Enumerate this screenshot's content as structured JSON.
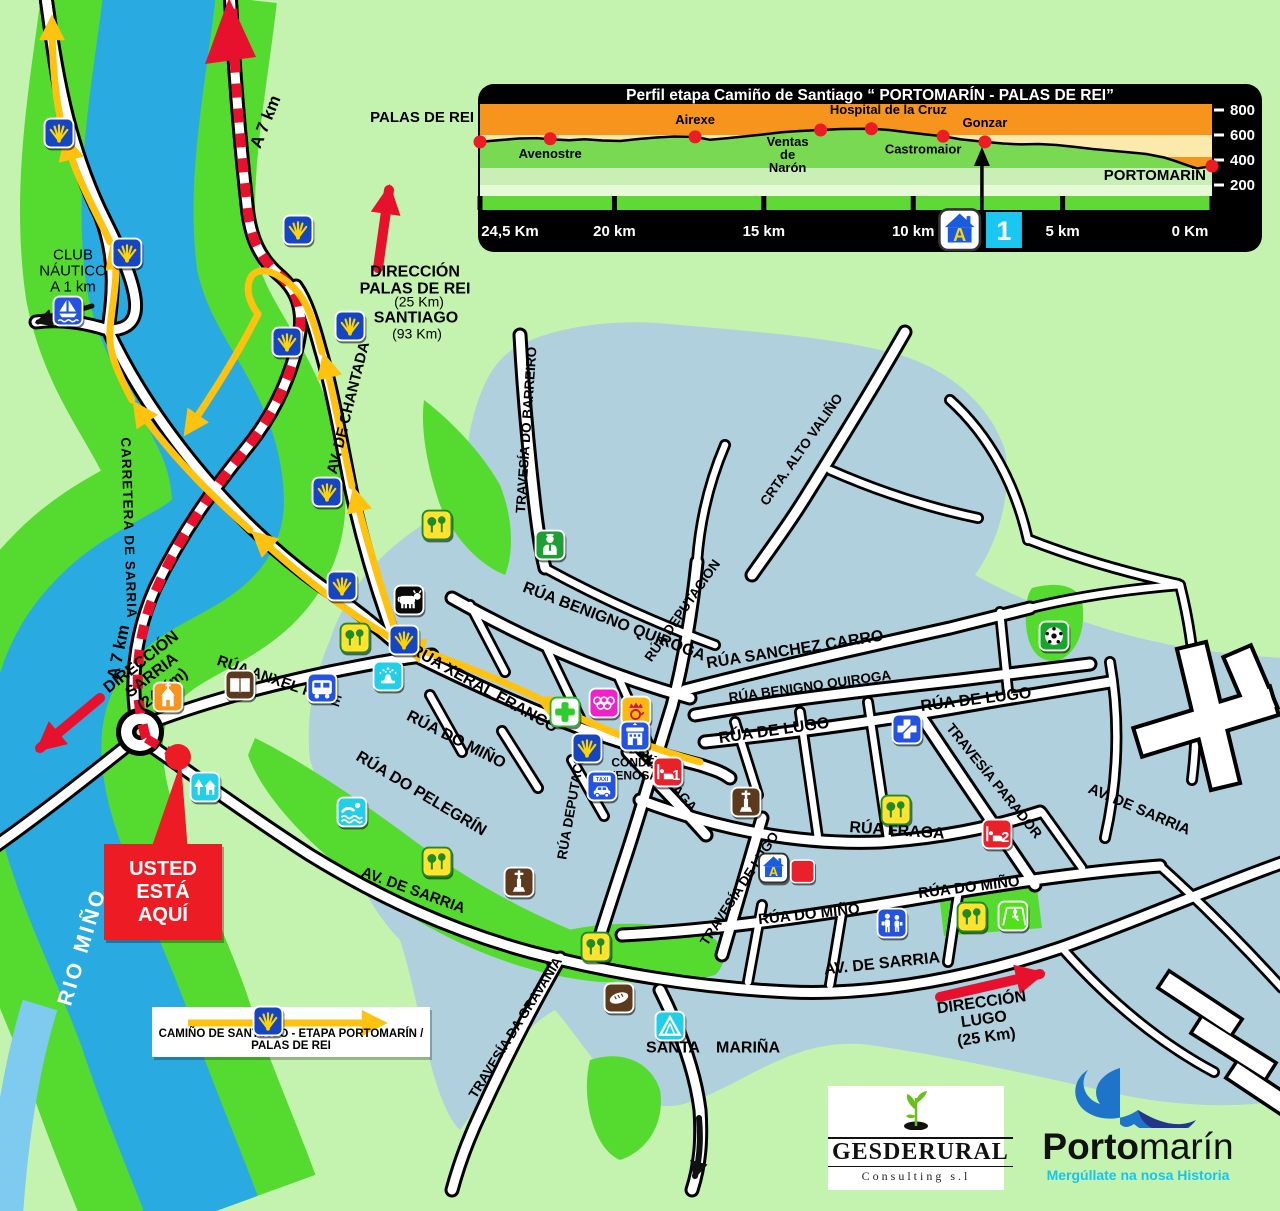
{
  "chart_data": {
    "type": "area",
    "title": "Perfil etapa Camiño de Santiago “ PORTOMARÍN - PALAS DE REI”",
    "xlabel": "distancia",
    "ylabel": "altitud (m)",
    "xlim": [
      24.5,
      0
    ],
    "ylim": [
      200,
      800
    ],
    "grid": false,
    "x_ticks": [
      "24,5 Km",
      "20 km",
      "15 km",
      "10 km",
      "5 km",
      "0 Km"
    ],
    "x_tick_values": [
      24.5,
      20,
      15,
      10,
      5,
      0
    ],
    "y_ticks": [
      "800",
      "600",
      "400",
      "200"
    ],
    "y_tick_values": [
      800,
      600,
      400,
      200
    ],
    "profile": [
      [
        24.5,
        545
      ],
      [
        23.8,
        560
      ],
      [
        23.2,
        572
      ],
      [
        22.6,
        575
      ],
      [
        22.1,
        565
      ],
      [
        21.5,
        558
      ],
      [
        21.0,
        566
      ],
      [
        20.4,
        556
      ],
      [
        19.8,
        552
      ],
      [
        19.2,
        568
      ],
      [
        18.6,
        580
      ],
      [
        18.0,
        588
      ],
      [
        17.3,
        585
      ],
      [
        16.8,
        562
      ],
      [
        16.2,
        575
      ],
      [
        15.6,
        590
      ],
      [
        15.0,
        605
      ],
      [
        14.4,
        622
      ],
      [
        13.8,
        632
      ],
      [
        13.1,
        640
      ],
      [
        12.4,
        648
      ],
      [
        11.4,
        650
      ],
      [
        10.8,
        640
      ],
      [
        10.2,
        622
      ],
      [
        9.6,
        605
      ],
      [
        9.0,
        590
      ],
      [
        8.4,
        565
      ],
      [
        7.6,
        545
      ],
      [
        7.0,
        532
      ],
      [
        6.4,
        525
      ],
      [
        5.8,
        528
      ],
      [
        5.2,
        520
      ],
      [
        4.6,
        505
      ],
      [
        4.0,
        488
      ],
      [
        3.4,
        475
      ],
      [
        2.8,
        462
      ],
      [
        2.2,
        448
      ],
      [
        1.6,
        420
      ],
      [
        1.2,
        390
      ],
      [
        0.8,
        355
      ],
      [
        0.5,
        332
      ],
      [
        0.25,
        342
      ],
      [
        0.0,
        352
      ]
    ],
    "waypoints": [
      {
        "label": "PALAS DE REI",
        "km": 24.5,
        "elev": 545
      },
      {
        "label": "Avenostre",
        "km": 22.15,
        "elev": 570
      },
      {
        "label": "Airexe",
        "km": 17.3,
        "elev": 585
      },
      {
        "label": "Ventas de Narón",
        "km": 13.1,
        "elev": 640
      },
      {
        "label": "Hospital de la Cruz",
        "km": 11.4,
        "elev": 650
      },
      {
        "label": "Castromaior",
        "km": 9.0,
        "elev": 590
      },
      {
        "label": "Gonzar",
        "km": 7.6,
        "elev": 545
      },
      {
        "label": "PORTOMARÍN",
        "km": 0,
        "elev": 352
      }
    ],
    "marker": {
      "icon": "albergue",
      "badge": "1",
      "km": 7.6
    }
  },
  "map": {
    "you_are_here": {
      "text": "USTED\nESTÁ\nAQUÍ"
    },
    "legend": {
      "text": "CAMIÑO DE SANTIAGO  -  ETAPA PORTOMARÍN / PALAS DE REI"
    },
    "labels": [
      {
        "n": "club-nautico-label",
        "t": "CLUB\nNÁUTICO\nA 1 km",
        "x": 73,
        "y": 272,
        "s": 15,
        "w": 500
      },
      {
        "n": "direccion-palas-de-rei-label",
        "t": "DIRECCIÓN\nPALAS DE REI",
        "x": 415,
        "y": 281,
        "s": 16,
        "w": 700
      },
      {
        "n": "palas-distance-label",
        "t": "(25 Km)",
        "x": 419,
        "y": 302,
        "s": 14,
        "w": 400
      },
      {
        "n": "santiago-label",
        "t": "SANTIAGO",
        "x": 416,
        "y": 318,
        "s": 16,
        "w": 700
      },
      {
        "n": "santiago-distance-label",
        "t": "(93 Km)",
        "x": 417,
        "y": 334,
        "s": 14,
        "w": 400
      },
      {
        "n": "a-7-km-label-top",
        "t": "A 7 km",
        "x": 266,
        "y": 122,
        "r": -68,
        "s": 17,
        "w": 700
      },
      {
        "n": "a-7-km-label-low",
        "t": "A 7 km",
        "x": 119,
        "y": 652,
        "r": -78,
        "s": 17,
        "w": 700
      },
      {
        "n": "carretera-de-sarria-label",
        "t": "CARRETERA DE SARRIA",
        "x": 128,
        "y": 528,
        "r": 88,
        "s": 13.5,
        "w": 700,
        "sp": 1
      },
      {
        "n": "av-de-chantada-label",
        "t": "AV. DE CHANTADA",
        "x": 349,
        "y": 408,
        "r": -76,
        "s": 15,
        "w": 700
      },
      {
        "n": "direccion-sarria-label",
        "t": "DIRECCIÓN\nSARRIA\n(24 Km)",
        "x": 152,
        "y": 676,
        "r": -38,
        "s": 16,
        "w": 700
      },
      {
        "n": "rio-mino-label",
        "t": "RIO MIÑO",
        "x": 83,
        "y": 947,
        "r": -73,
        "s": 21,
        "w": 700,
        "c": "#ffffff",
        "sp": 3
      },
      {
        "n": "travesia-do-barreiro-label",
        "t": "TRAVESÍA DO BARREIRO",
        "x": 527,
        "y": 430,
        "r": -86,
        "s": 13.5,
        "w": 700
      },
      {
        "n": "crta-alto-valino-label",
        "t": "CRTA. ALTO VALIÑO",
        "x": 802,
        "y": 450,
        "r": -55,
        "s": 13.5,
        "w": 700
      },
      {
        "n": "rua-deputacion-upper-label",
        "t": "RÚA DEPUTACIÓN",
        "x": 683,
        "y": 611,
        "r": -55,
        "s": 13.5,
        "w": 700
      },
      {
        "n": "rua-benigno-quiroga-label",
        "t": "RÚA BENIGNO QUIROGA",
        "x": 614,
        "y": 622,
        "r": 21,
        "s": 16,
        "w": 700
      },
      {
        "n": "rua-sanchez-carro-label",
        "t": "RÚA SANCHEZ CARRO",
        "x": 795,
        "y": 650,
        "r": -9,
        "s": 16,
        "w": 700
      },
      {
        "n": "rua-benigno-quiroga-2-label",
        "t": "RÚA BENIGNO QUIROGA",
        "x": 810,
        "y": 687,
        "r": -8,
        "s": 13.5,
        "w": 700
      },
      {
        "n": "rua-de-lugo-label",
        "t": "RÚA DE LUGO",
        "x": 774,
        "y": 731,
        "r": -8,
        "s": 16,
        "w": 700
      },
      {
        "n": "rua-de-lugo-2-label",
        "t": "RÚA DE LUGO",
        "x": 976,
        "y": 700,
        "r": -7,
        "s": 16,
        "w": 700
      },
      {
        "n": "travesia-parador-label",
        "t": "TRAVESÍA PARADOR",
        "x": 994,
        "y": 781,
        "r": 51,
        "s": 14,
        "w": 700
      },
      {
        "n": "rua-xeral-franco-label",
        "t": "RÚA XERAL FRANCO",
        "x": 484,
        "y": 689,
        "r": 29,
        "s": 16,
        "w": 700
      },
      {
        "n": "rua-do-mino-label",
        "t": "RÚA DO MIÑO",
        "x": 456,
        "y": 740,
        "r": 27,
        "s": 16,
        "w": 700
      },
      {
        "n": "rua-do-pelegrin-label",
        "t": "RÚA DO PELEGRÍN",
        "x": 421,
        "y": 794,
        "r": 31,
        "s": 16,
        "w": 700
      },
      {
        "n": "rua-deputacion-label",
        "t": "RÚA DEPUTACIÓN",
        "x": 573,
        "y": 800,
        "r": -80,
        "s": 13.5,
        "w": 700
      },
      {
        "n": "rua-fraga-label",
        "t": "RÚA FRAGA",
        "x": 667,
        "y": 780,
        "r": 48,
        "s": 13.5,
        "w": 700
      },
      {
        "n": "rua-fraga-2-label",
        "t": "RÚA FRAGA",
        "x": 897,
        "y": 831,
        "r": 4,
        "s": 16,
        "w": 700
      },
      {
        "n": "travesia-de-lugo-label",
        "t": "TRAVESÍA DE LUGO",
        "x": 740,
        "y": 889,
        "r": -57,
        "s": 13.5,
        "w": 700
      },
      {
        "n": "rua-do-mino-2-label",
        "t": "RÚA DO MIÑO",
        "x": 809,
        "y": 915,
        "r": -6,
        "s": 15,
        "w": 700
      },
      {
        "n": "rua-do-mino-3-label",
        "t": "RÚA DO MIÑO",
        "x": 969,
        "y": 888,
        "r": -7,
        "s": 15,
        "w": 700
      },
      {
        "n": "av-de-sarria-w-label",
        "t": "AV. DE SARRIA",
        "x": 413,
        "y": 891,
        "r": 20,
        "s": 15,
        "w": 700
      },
      {
        "n": "av-de-sarria-c-label",
        "t": "AV. DE SARRIA",
        "x": 882,
        "y": 964,
        "r": -6,
        "s": 16,
        "w": 700
      },
      {
        "n": "av-de-sarria-e-label",
        "t": "AV. DE SARRIA",
        "x": 1139,
        "y": 810,
        "r": 23,
        "s": 15,
        "w": 700
      },
      {
        "n": "travesia-da-gravania-label",
        "t": "TRAVESÍA DA GRAVANÍA",
        "x": 516,
        "y": 1028,
        "r": -58,
        "s": 13.5,
        "w": 700
      },
      {
        "n": "rua-anxel-fole-label",
        "t": "RÚA ANXEL FOLE",
        "x": 279,
        "y": 682,
        "r": 19,
        "s": 15,
        "w": 700
      },
      {
        "n": "pza-conde-fenosa-label",
        "t": "Pza.\nCONDE\nFENOSA",
        "x": 633,
        "y": 763,
        "s": 12,
        "w": 700
      },
      {
        "n": "santa-label",
        "t": "SANTA",
        "x": 673,
        "y": 1048,
        "s": 16,
        "w": 700
      },
      {
        "n": "marina-label",
        "t": "MARIÑA",
        "x": 748,
        "y": 1048,
        "s": 16,
        "w": 700
      },
      {
        "n": "direccion-lugo-label",
        "t": "DIRECCIÓN\nLUGO\n(25 Km)",
        "x": 984,
        "y": 1020,
        "r": -8,
        "s": 16,
        "w": 700
      }
    ],
    "icons": [
      {
        "type": "shell",
        "x": 59,
        "y": 133
      },
      {
        "type": "shell",
        "x": 127,
        "y": 253
      },
      {
        "type": "shell",
        "x": 298,
        "y": 230
      },
      {
        "type": "shell",
        "x": 287,
        "y": 342
      },
      {
        "type": "shell",
        "x": 350,
        "y": 326
      },
      {
        "type": "shell",
        "x": 327,
        "y": 492
      },
      {
        "type": "shell",
        "x": 342,
        "y": 586
      },
      {
        "type": "shell",
        "x": 404,
        "y": 640
      },
      {
        "type": "shell",
        "x": 587,
        "y": 748
      },
      {
        "type": "shell",
        "x": 268,
        "y": 1021
      },
      {
        "type": "sailboat",
        "x": 68,
        "y": 311
      },
      {
        "type": "church",
        "x": 168,
        "y": 697
      },
      {
        "type": "book",
        "x": 240,
        "y": 685
      },
      {
        "type": "parkhouse",
        "x": 205,
        "y": 787
      },
      {
        "type": "bus",
        "x": 322,
        "y": 688
      },
      {
        "type": "fountain",
        "x": 388,
        "y": 676
      },
      {
        "type": "cow",
        "x": 409,
        "y": 600
      },
      {
        "type": "park",
        "x": 355,
        "y": 638
      },
      {
        "type": "park",
        "x": 437,
        "y": 525
      },
      {
        "type": "doctor",
        "x": 550,
        "y": 545
      },
      {
        "type": "pharmacy",
        "x": 565,
        "y": 712
      },
      {
        "type": "rings",
        "x": 604,
        "y": 703
      },
      {
        "type": "post",
        "x": 636,
        "y": 711
      },
      {
        "type": "townhall",
        "x": 635,
        "y": 736
      },
      {
        "type": "taxi",
        "x": 602,
        "y": 786
      },
      {
        "type": "hotel",
        "x": 668,
        "y": 772,
        "badge": "1"
      },
      {
        "type": "monument",
        "x": 746,
        "y": 802
      },
      {
        "type": "hospital",
        "x": 907,
        "y": 729
      },
      {
        "type": "soccer",
        "x": 1054,
        "y": 636
      },
      {
        "type": "park",
        "x": 896,
        "y": 810
      },
      {
        "type": "hotel",
        "x": 997,
        "y": 834,
        "badge": "2"
      },
      {
        "type": "albergue",
        "x": 787,
        "y": 868,
        "attach": "red"
      },
      {
        "type": "school",
        "x": 892,
        "y": 923
      },
      {
        "type": "park",
        "x": 972,
        "y": 917
      },
      {
        "type": "swing",
        "x": 1013,
        "y": 916
      },
      {
        "type": "pool",
        "x": 352,
        "y": 812
      },
      {
        "type": "monument",
        "x": 519,
        "y": 882
      },
      {
        "type": "park",
        "x": 437,
        "y": 862
      },
      {
        "type": "park",
        "x": 596,
        "y": 947
      },
      {
        "type": "bakery",
        "x": 619,
        "y": 998
      },
      {
        "type": "camping",
        "x": 670,
        "y": 1026
      }
    ]
  },
  "icon_labels": {
    "taxi": "TAXI",
    "albergue_letter": "A"
  },
  "logos": {
    "gesderural": {
      "name": "GESDERURAL",
      "sub": "Consulting s.l"
    },
    "portomarin": {
      "part1": "Porto",
      "part2": "marín",
      "tagline": "Mergúllate na nosa Historia"
    }
  }
}
